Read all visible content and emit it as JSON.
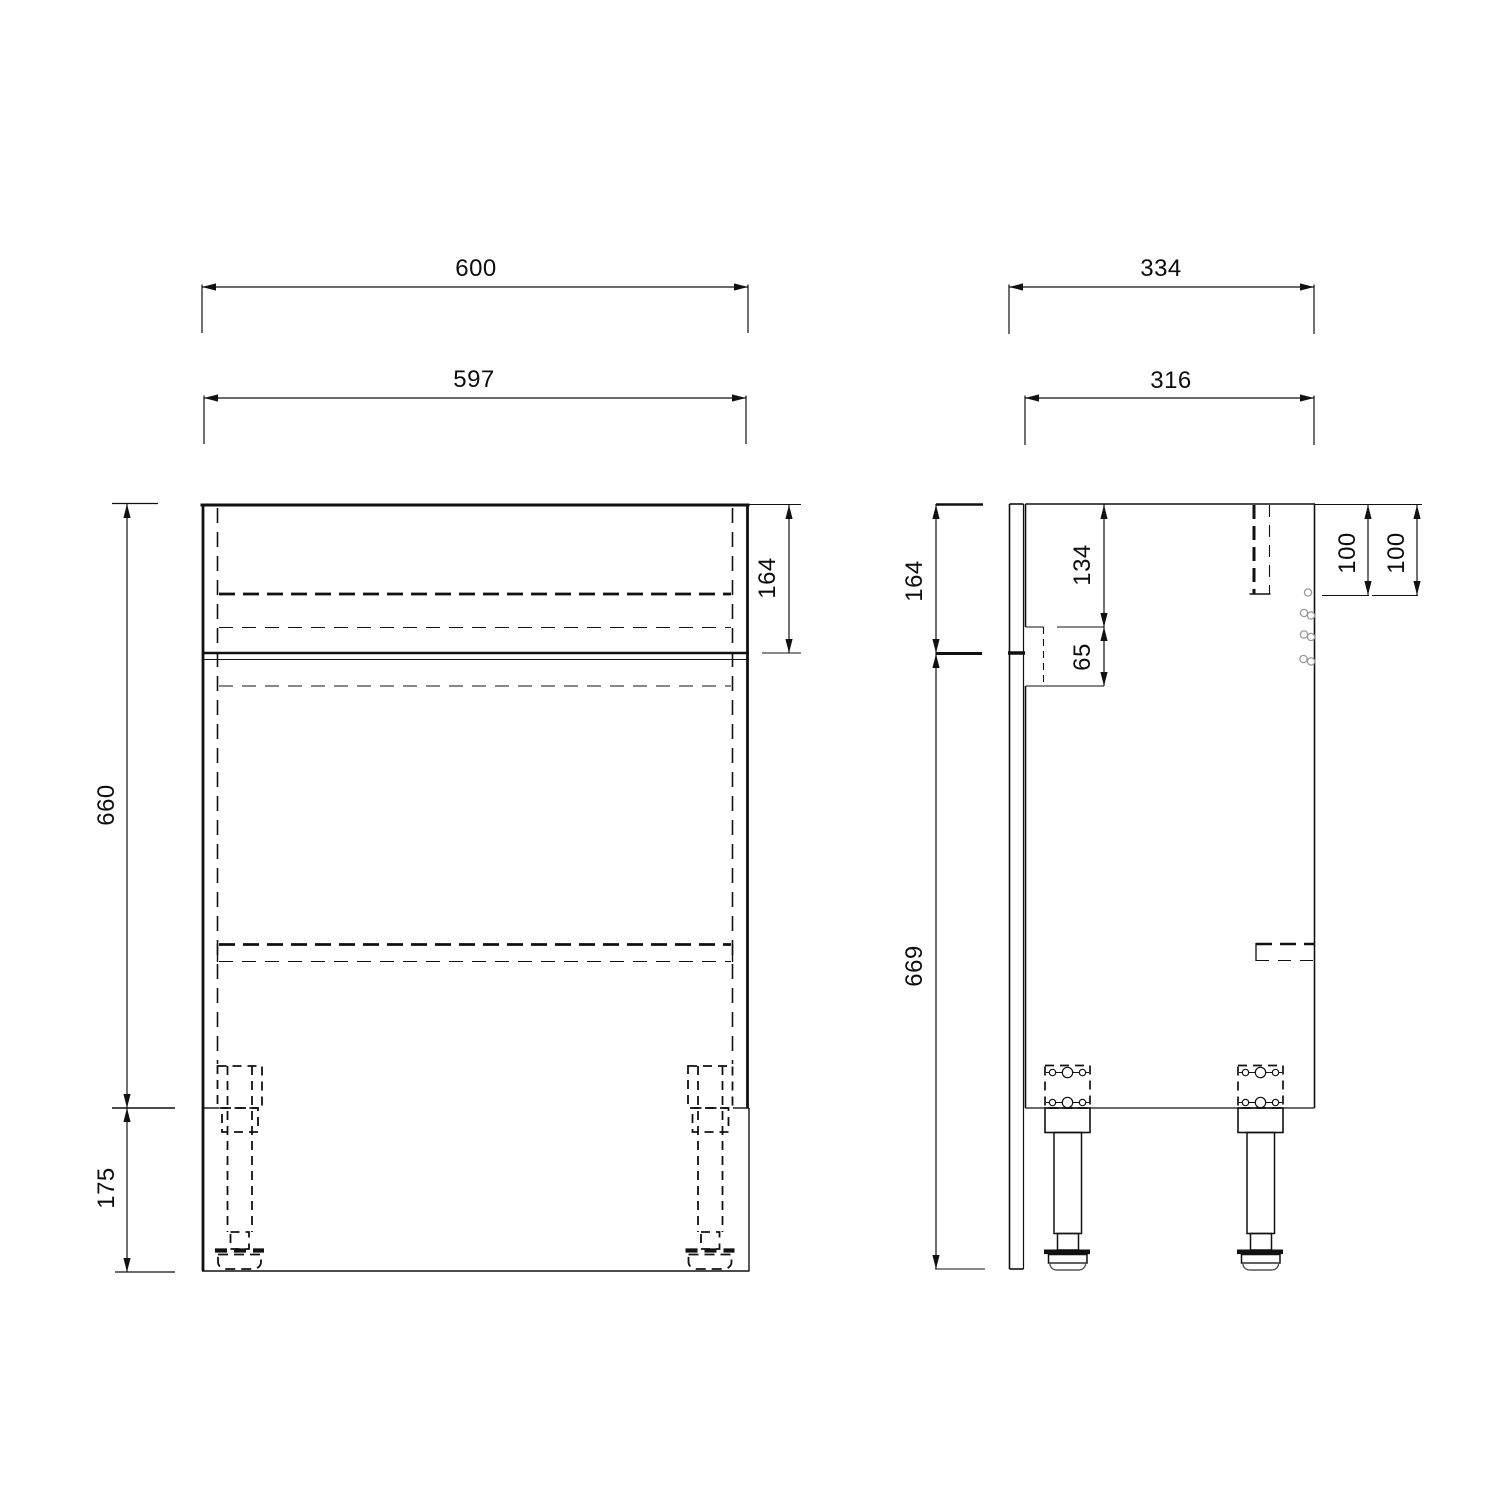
{
  "document": {
    "type": "technical-drawing",
    "subject": "bathroom furniture base unit - front and side elevations",
    "unit": "mm",
    "background_color": "#ffffff",
    "line_color": "#111111"
  },
  "front_view": {
    "label": "front elevation",
    "dims": {
      "overall_width": "600",
      "carcass_width": "597",
      "top_section_height": "164",
      "carcass_height": "660",
      "leg_height": "175"
    }
  },
  "side_view": {
    "label": "side elevation",
    "dims": {
      "overall_depth": "334",
      "panel_depth": "316",
      "top_section_height": "164",
      "body_height": "669",
      "cutout_top_offset": "134",
      "cutout_height": "65",
      "hole_offset_front": "100",
      "hole_offset_back": "100"
    }
  }
}
